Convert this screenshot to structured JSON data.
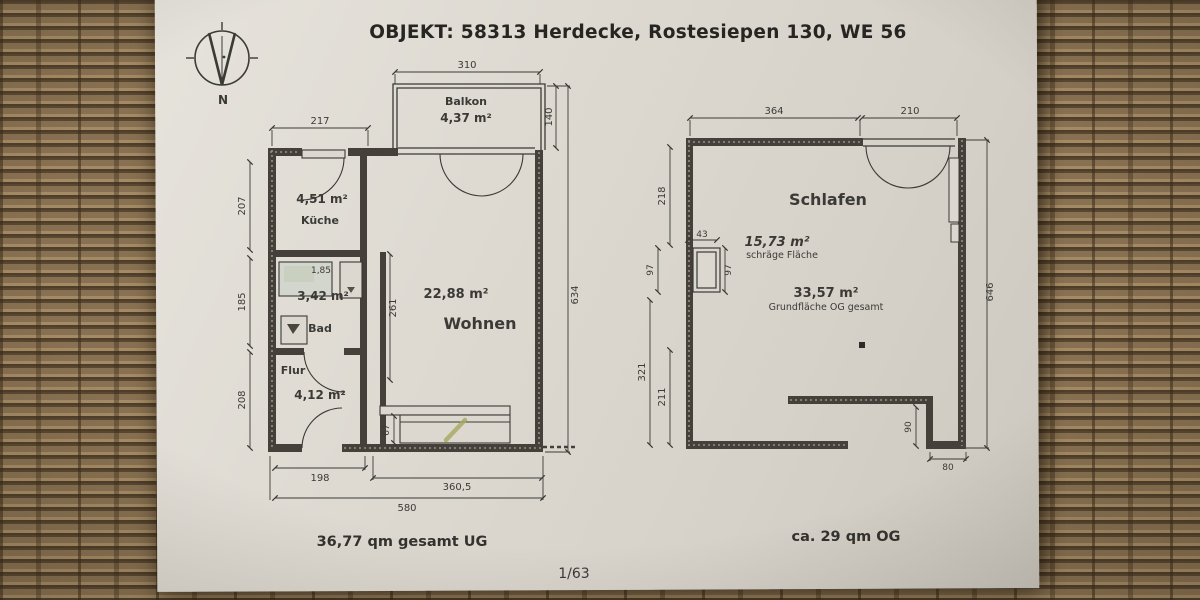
{
  "header": {
    "title": "OBJEKT:  58313 Herdecke, Rostesiepen 130, WE 56"
  },
  "compass": {
    "north_label": "N"
  },
  "plans": {
    "left": {
      "rooms": {
        "balkon": {
          "name": "Balkon",
          "area": "4,37 m²"
        },
        "kueche": {
          "name": "Küche",
          "area": "4,51 m²"
        },
        "bad": {
          "name": "Bad",
          "area": "3,42 m²",
          "interior_dim": "1,85"
        },
        "flur": {
          "name": "Flur",
          "area": "4,12 m²"
        },
        "wohnen": {
          "name": "Wohnen",
          "area": "22,88 m²"
        }
      },
      "dims": {
        "balkon_width": "310",
        "balkon_depth": "140",
        "kueche_width": "217",
        "kueche_height": "207",
        "bad_height": "185",
        "flur_height": "208",
        "total_height": "634",
        "wohnen_height": "261",
        "radiator_depth": "67",
        "flur_width": "198",
        "wohnen_width": "360,5",
        "total_width": "580"
      },
      "footer": "36,77 qm  gesamt UG"
    },
    "right": {
      "rooms": {
        "schlafen": {
          "name": "Schlafen"
        }
      },
      "areas": {
        "sloped": {
          "value": "15,73 m²",
          "label": "schräge Fläche"
        },
        "total": {
          "value": "33,57 m²",
          "label": "Grundfläche OG gesamt"
        }
      },
      "dims": {
        "top_left": "364",
        "top_right": "210",
        "left_upper": "218",
        "chimney_width": "43",
        "chimney_left": "97",
        "chimney_right": "97",
        "left_outer": "321",
        "left_inner": "211",
        "right_total": "646",
        "notch_height": "90",
        "notch_width": "80"
      },
      "footer": "ca. 29 qm  OG"
    }
  },
  "page_number": "1/63",
  "colors": {
    "ink": "#3b3a36",
    "paper": "#dcd8d0",
    "highlight_mark": "#a8a85f"
  }
}
